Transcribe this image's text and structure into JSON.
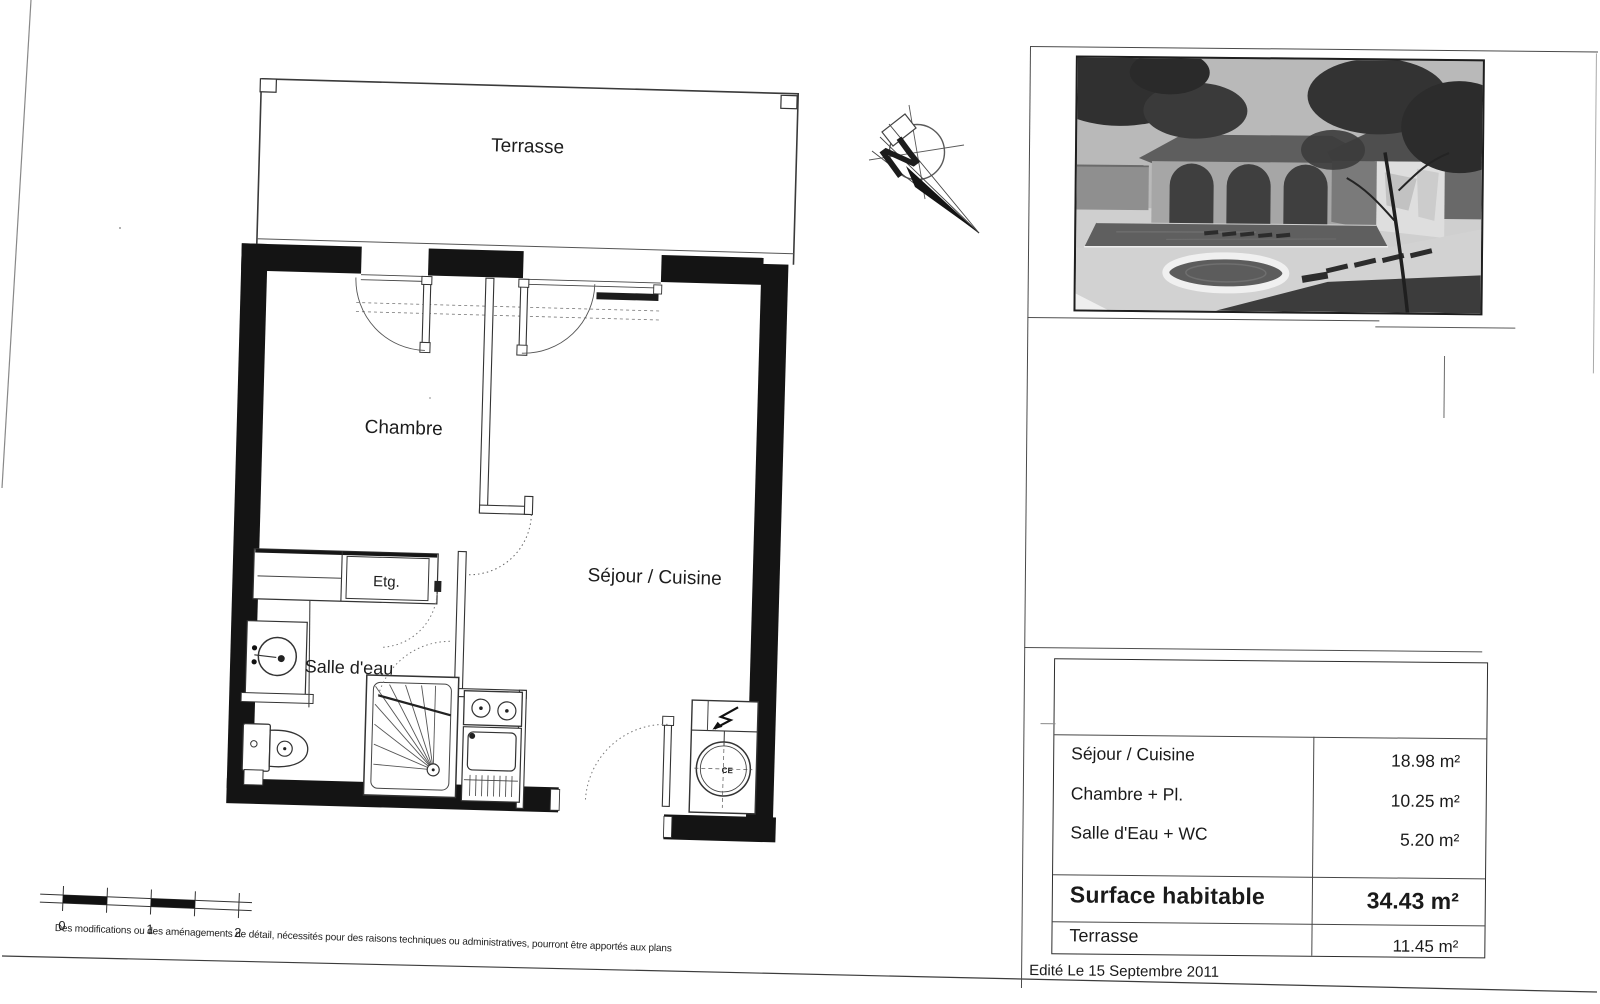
{
  "sheet": {
    "disclaimer": "Des modifications ou des aménagements de détail, nécessités pour des raisons techniques ou administratives, pourront être apportés aux plans",
    "edited_date": "Edité Le 15 Septembre 2011"
  },
  "plan": {
    "labels": {
      "terrace": "Terrasse",
      "bedroom": "Chambre",
      "living_kitchen": "Séjour / Cuisine",
      "bathroom": "Salle d'eau",
      "shelf": "Etg.",
      "water_heater": "CE"
    },
    "compass_north": "N",
    "scale": {
      "t0": "0",
      "t1": "1",
      "t2": "2"
    }
  },
  "areas": {
    "rows": [
      {
        "label": "Séjour / Cuisine",
        "value": "18.98 m²"
      },
      {
        "label": "Chambre + Pl.",
        "value": "10.25 m²"
      },
      {
        "label": "Salle d'Eau + WC",
        "value": "5.20 m²"
      }
    ],
    "total_label": "Surface habitable",
    "total_value": "34.43 m²",
    "terrace_label": "Terrasse",
    "terrace_value": "11.45 m²"
  }
}
